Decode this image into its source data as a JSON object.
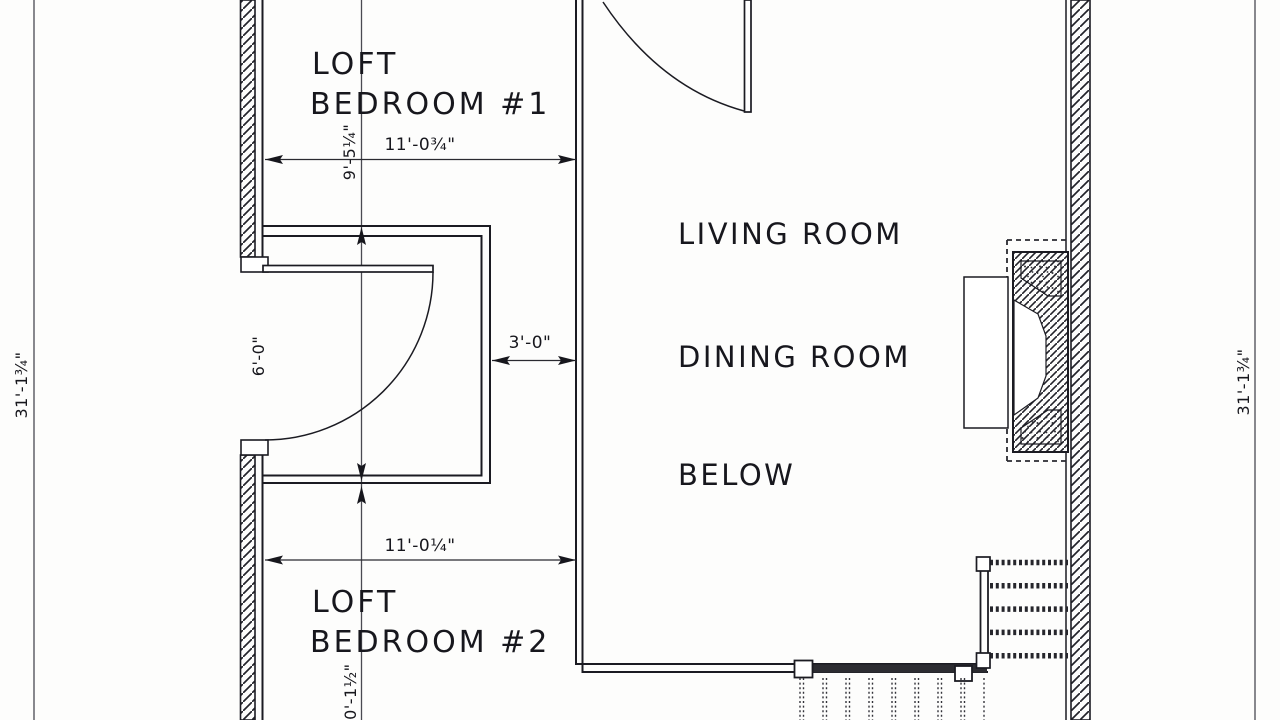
{
  "drawing": {
    "title": "loft level floor plan (scanned blueprint)",
    "labels": {
      "bedroom1_line1": "LOFT",
      "bedroom1_line2": "BEDROOM #1",
      "bedroom2_line1": "LOFT",
      "bedroom2_line2": "BEDROOM #2",
      "open_below_line1": "LIVING ROOM",
      "open_below_line2": "DINING ROOM",
      "open_below_line3": "BELOW"
    },
    "dimensions": {
      "overall_left": "31'-1¾\"",
      "overall_right": "31'-1¾\"",
      "bedroom1_width": "11'-0¾\"",
      "closet_depth": "9'-5¼\"",
      "door_opening": "6'-0\"",
      "hall_width": "3'-0\"",
      "bedroom2_width": "11'-0¼\"",
      "bedroom2_depth": "10'-1½\""
    },
    "line_color": "#1b1b22",
    "paper_color": "#fdfdfc"
  }
}
